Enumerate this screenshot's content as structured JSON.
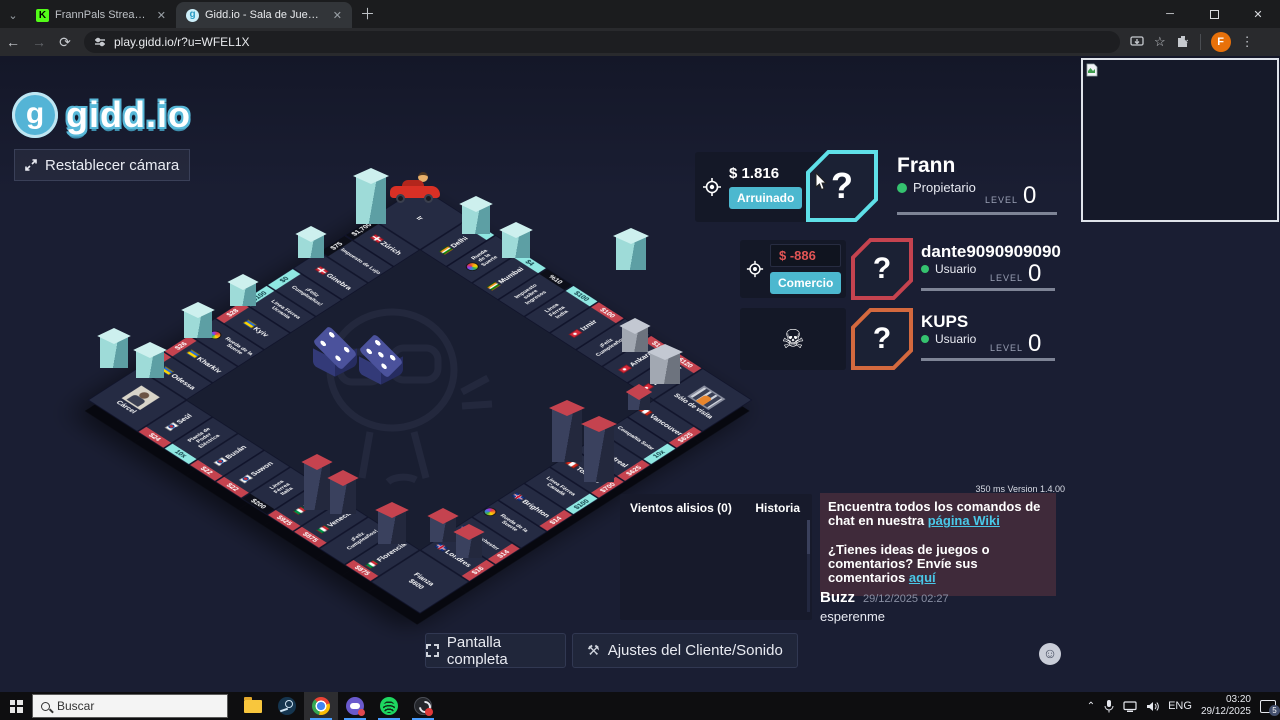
{
  "browser": {
    "tabs": [
      {
        "title": "FrannPals Stream - Watch Live",
        "favicon": "kick",
        "close": "✕"
      },
      {
        "title": "Gidd.io - Sala de Juegos de Fra",
        "favicon": "giddio",
        "close": "✕"
      }
    ],
    "url": "play.gidd.io/r?u=WFEL1X",
    "profile_initial": "F"
  },
  "game": {
    "logo_text": "gidd.io",
    "logo_glyph": "g",
    "reset_camera_label": "Restablecer cámara",
    "latency_version": "350 ms Version 1.4.00",
    "players": [
      {
        "name": "Frann",
        "role": "Propietario",
        "money": "$ 1.816",
        "action": "Arruinado",
        "level_label": "LEVEL",
        "level": "0",
        "avatar_glyph": "?",
        "border_color": "#5fe0e8"
      },
      {
        "name": "dante9090909090",
        "role": "Usuario",
        "money": "$ -886",
        "action": "Comercio",
        "level_label": "LEVEL",
        "level": "0",
        "avatar_glyph": "?",
        "border_color": "#c5434f"
      },
      {
        "name": "KUPS",
        "role": "Usuario",
        "level_label": "LEVEL",
        "level": "0",
        "avatar_glyph": "?",
        "border_color": "#d4693e",
        "status_icon": "skull"
      }
    ],
    "chat": {
      "wiki_line1": "Encuentra todos los comandos de chat en nuestra ",
      "wiki_link1": "página Wiki",
      "wiki_line2": "¿Tienes ideas de juegos o comentarios? Envíe sus comentarios ",
      "wiki_link2": "aquí",
      "message_author": "Buzz",
      "message_time": "29/12/2025 02:27",
      "message_text": "esperenme"
    },
    "panel_tabs": {
      "trade_winds": "Vientos alisios (0)",
      "history": "Historia"
    },
    "footer_buttons": {
      "fullscreen": "Pantalla completa",
      "settings": "Ajustes del Cliente/Sonido"
    },
    "accent_colors": {
      "cyan_button": "#4cb8cf",
      "negative_money": "#e25555",
      "online_dot": "#35c26f"
    }
  },
  "board": {
    "corners": {
      "go": "Ir",
      "visiting": "Sólo de visita",
      "bail": "Fianza",
      "bail_price": "$600",
      "jail": "Cárcel"
    },
    "top": [
      {
        "name": "Delhi",
        "tag": "$2",
        "tagStyle": "cyan",
        "flag": "in"
      },
      {
        "name": "Rueda de la Suerte",
        "icon": "wheel"
      },
      {
        "name": "Mumbai",
        "tag": "$4",
        "tagStyle": "cyan",
        "flag": "in"
      },
      {
        "name": "Impuesto sobre Ingresos",
        "tag": "%10",
        "tagStyle": "dark"
      },
      {
        "name": "Línea Férrea India",
        "tag": "$100",
        "tagStyle": "cyan"
      },
      {
        "name": "Izmir",
        "tag": "$100",
        "tagStyle": "red",
        "flag": "tr"
      },
      {
        "name": "¡Feliz Cumpleaños!"
      },
      {
        "name": "Ankara",
        "tag": "$100",
        "tagStyle": "red",
        "flag": "tr"
      },
      {
        "name": "Estambúl",
        "tag": "$120",
        "tagStyle": "red",
        "flag": "tr"
      }
    ],
    "right": [
      {
        "name": "Vancouver",
        "tag": "$625",
        "tagStyle": "red",
        "flag": "ca"
      },
      {
        "name": "Compañía Solar",
        "tag": "10x",
        "tagStyle": "cyan"
      },
      {
        "name": "Montreal",
        "tag": "$625",
        "tagStyle": "red",
        "flag": "ca"
      },
      {
        "name": "Toronto",
        "tag": "$700",
        "tagStyle": "red",
        "flag": "ca"
      },
      {
        "name": "Línea Férrea Canadá",
        "tag": "$100",
        "tagStyle": "cyan"
      },
      {
        "name": "Brighton",
        "tag": "$14",
        "tagStyle": "red",
        "flag": "uk"
      },
      {
        "name": "Rueda de la Suerte",
        "icon": "wheel"
      },
      {
        "name": "Manchester",
        "tag": "$14",
        "tagStyle": "red",
        "flag": "uk"
      },
      {
        "name": "Londres",
        "tag": "$16",
        "tagStyle": "red",
        "flag": "uk"
      }
    ],
    "bottom": [
      {
        "name": "Florencia",
        "tag": "$875",
        "tagStyle": "red",
        "flag": "it"
      },
      {
        "name": "¡Feliz Cumpleaños!"
      },
      {
        "name": "Venecia",
        "tag": "$875",
        "tagStyle": "red",
        "flag": "it"
      },
      {
        "name": "Roma",
        "tag": "$925",
        "tagStyle": "red",
        "flag": "it"
      },
      {
        "name": "Línea Férrea Italia",
        "tag": "$200",
        "tagStyle": "dark"
      },
      {
        "name": "Suwon",
        "tag": "$22",
        "tagStyle": "red",
        "flag": "kr"
      },
      {
        "name": "Busán",
        "tag": "$22",
        "tagStyle": "red",
        "flag": "kr"
      },
      {
        "name": "Planta de Poder Eléctrica",
        "tag": "10x",
        "tagStyle": "cyan"
      },
      {
        "name": "Seúl",
        "tag": "$24",
        "tagStyle": "red",
        "flag": "kr"
      }
    ],
    "left": [
      {
        "name": "Odessa",
        "tag": "$26",
        "tagStyle": "red",
        "flag": "ua"
      },
      {
        "name": "Kharkiv",
        "tag": "$26",
        "tagStyle": "red",
        "flag": "ua"
      },
      {
        "name": "Rueda de la Suerte",
        "icon": "wheel"
      },
      {
        "name": "Kyiv",
        "tag": "$28",
        "tagStyle": "red",
        "flag": "ua"
      },
      {
        "name": "Línea Férrea Ucrania",
        "tag": "$100",
        "tagStyle": "cyan"
      },
      {
        "name": "¡Feliz Cumpleaños!",
        "tag": "$0",
        "tagStyle": "cyan"
      },
      {
        "name": "Ginebra",
        "flag": "ch"
      },
      {
        "name": "Impuesto de Lujo",
        "tag": "$75",
        "tagStyle": "dark"
      },
      {
        "name": "Zúrich",
        "tag": "$1,700",
        "tagStyle": "dark",
        "flag": "ch"
      }
    ],
    "dice": [
      4,
      5
    ]
  },
  "taskbar": {
    "search_placeholder": "Buscar",
    "language": "ENG",
    "time": "03:20",
    "date": "29/12/2025",
    "notification_count": "5"
  }
}
